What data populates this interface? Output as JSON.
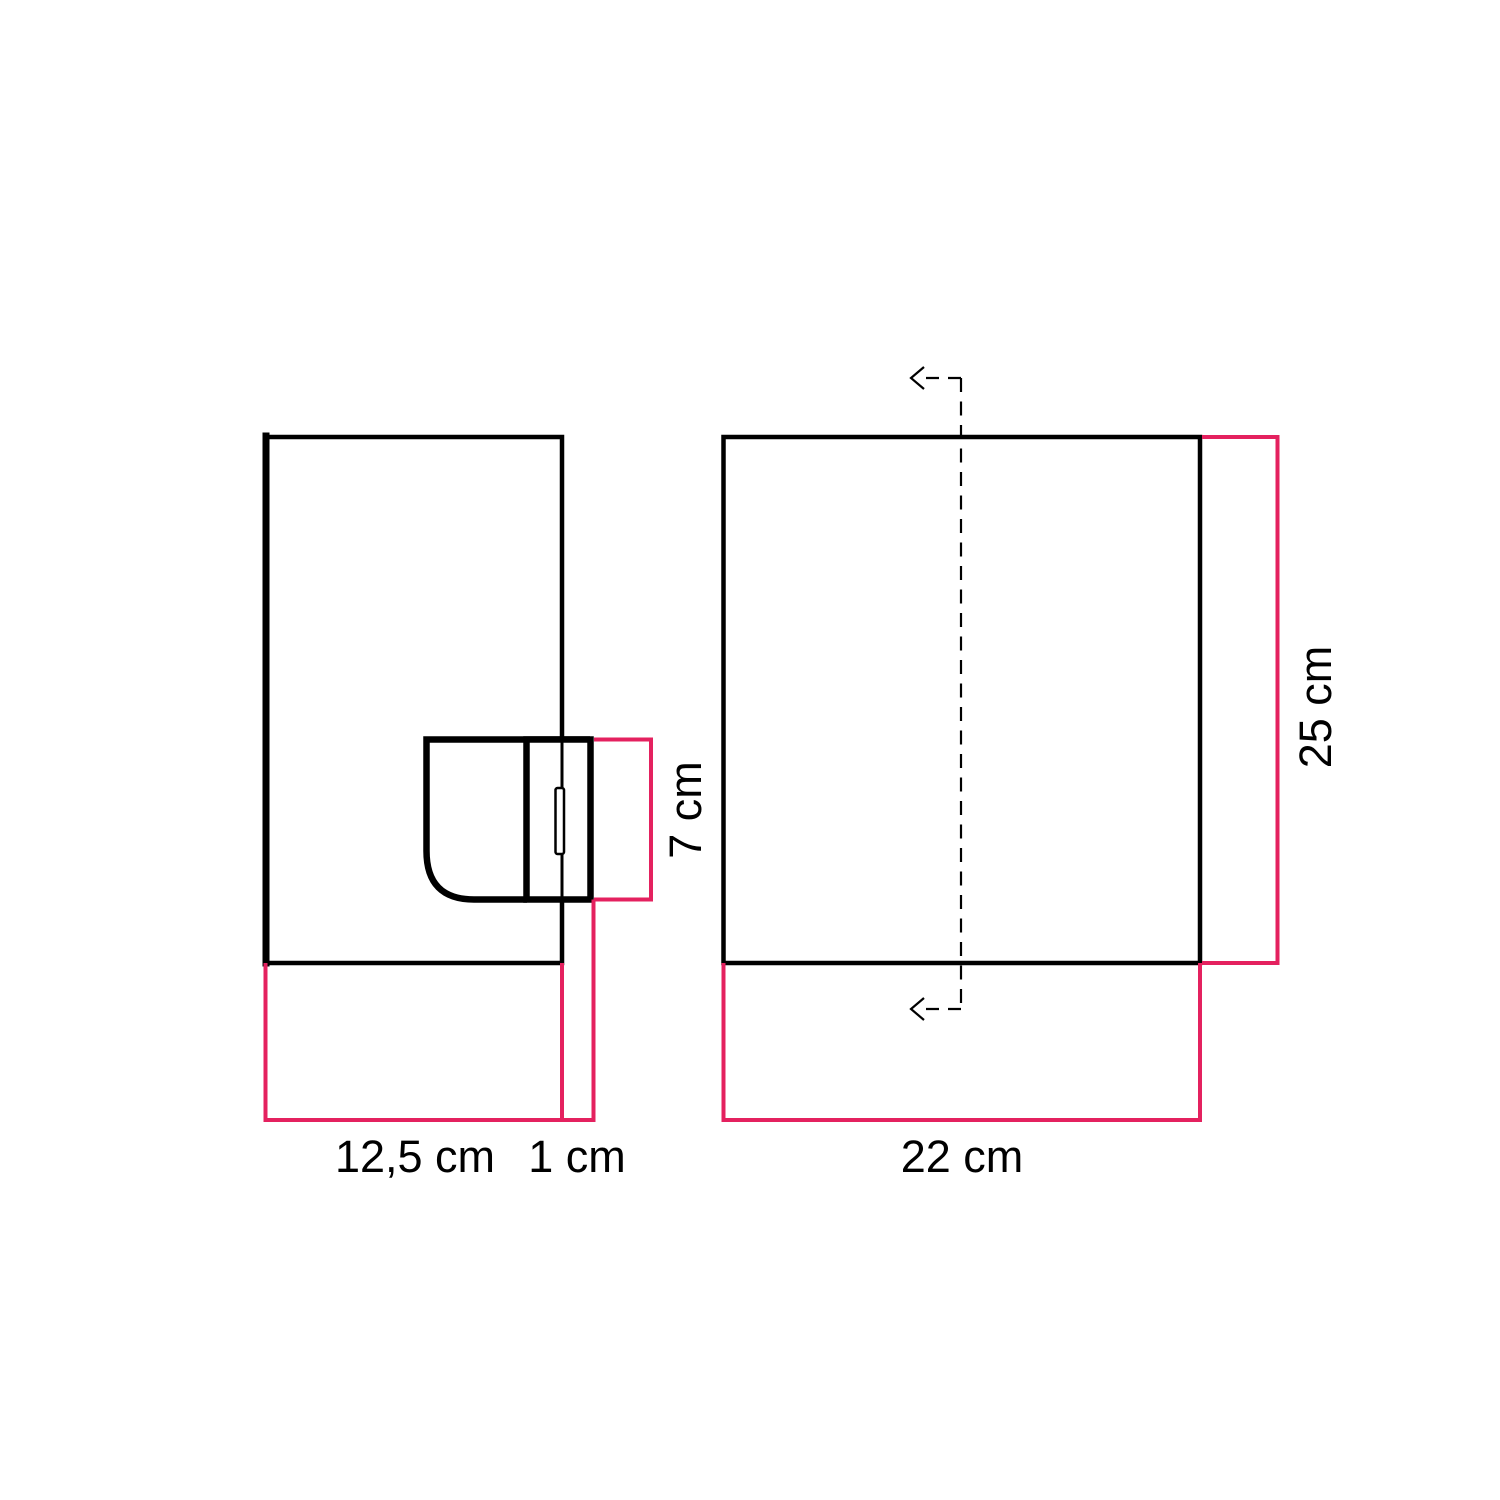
{
  "colors": {
    "background": "#ffffff",
    "outline": "#000000",
    "dimension_line": "#e4215f",
    "label_text": "#000000"
  },
  "views": {
    "side_view": {
      "dimensions": {
        "shade_width": {
          "label": "12,5 cm"
        },
        "plate_depth": {
          "label": "1 cm"
        },
        "holder_height": {
          "label": "7 cm"
        }
      }
    },
    "front_view": {
      "dimensions": {
        "shade_width": {
          "label": "22 cm"
        },
        "shade_height": {
          "label": "25 cm"
        }
      }
    }
  }
}
